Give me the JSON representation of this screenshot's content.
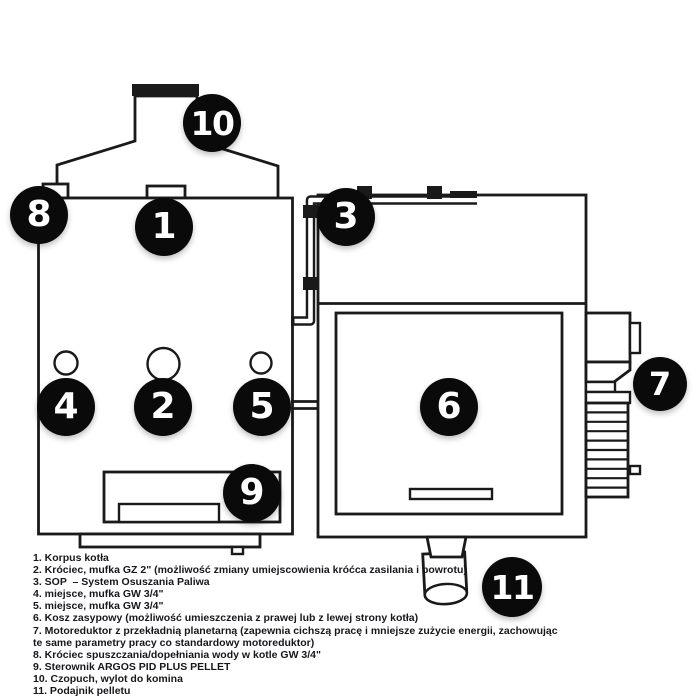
{
  "colors": {
    "line": "#1a1a1a",
    "callout_background": "#0a0a0a",
    "callout_text": "#ffffff",
    "legend_text": "#17171c",
    "background": "#ffffff"
  },
  "diagram": {
    "callouts": [
      {
        "number": "1"
      },
      {
        "number": "2"
      },
      {
        "number": "3"
      },
      {
        "number": "4"
      },
      {
        "number": "5"
      },
      {
        "number": "6"
      },
      {
        "number": "7"
      },
      {
        "number": "8"
      },
      {
        "number": "9"
      },
      {
        "number": "10"
      },
      {
        "number": "11"
      }
    ]
  },
  "legend": {
    "rows": [
      "1. Korpus kotła",
      "2. Króciec, mufka GZ 2\" (możliwość zmiany umiejscowienia króćca zasilania i powrotu)",
      "3. SOP  – System Osuszania Paliwa",
      "4. miejsce, mufka GW 3/4\"",
      "5. miejsce, mufka GW 3/4\"",
      "6. Kosz zasypowy (możliwość umieszczenia z prawej lub z lewej strony kotła)",
      "7. Motoreduktor z przekładnią planetarną (zapewnia cichszą pracę i mniejsze zużycie energii, zachowując",
      "te same parametry pracy co standardowy motoreduktor)",
      "8. Króciec spuszczania/dopełniania wody w kotle GW 3/4\"",
      "9. Sterownik ARGOS PID PLUS PELLET",
      "10. Czopuch, wylot do komina",
      "11. Podajnik pelletu"
    ]
  }
}
